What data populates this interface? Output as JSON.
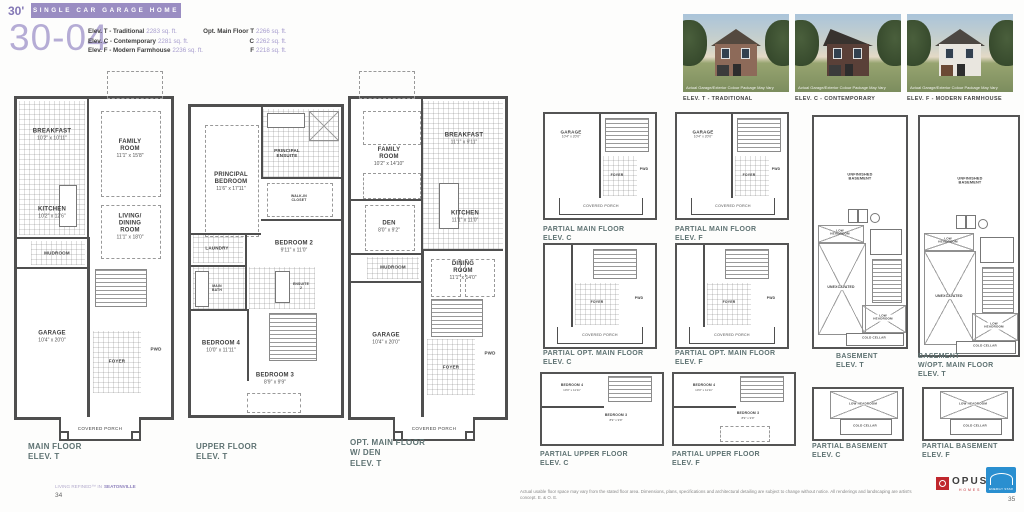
{
  "header": {
    "lot_width": "30'",
    "banner_title": "SINGLE CAR GARAGE HOME",
    "model_number": "30-04"
  },
  "specs": {
    "rows": [
      {
        "label": "Elev. T - Traditional",
        "value": "2283 sq. ft."
      },
      {
        "label": "Elev. C - Contemporary",
        "value": "2281 sq. ft."
      },
      {
        "label": "Elev. F - Modern Farmhouse",
        "value": "2236 sq. ft."
      }
    ],
    "opt_rows": [
      {
        "label": "Opt. Main Floor T",
        "value": "2266 sq. ft."
      },
      {
        "label": "C",
        "value": "2262 sq. ft."
      },
      {
        "label": "F",
        "value": "2218 sq. ft."
      }
    ]
  },
  "elevation_photos": [
    {
      "caption": "ELEV. T - TRADITIONAL",
      "note": "Actual Garage/Exterior Colour Package May Vary"
    },
    {
      "caption": "ELEV. C - CONTEMPORARY",
      "note": "Actual Garage/Exterior Colour Package May Vary"
    },
    {
      "caption": "ELEV. F - MODERN FARMHOUSE",
      "note": "Actual Garage/Exterior Colour Package May Vary"
    }
  ],
  "plans": {
    "main_t": {
      "label": "MAIN FLOOR\nELEV. T",
      "breakfast_name": "BREAKFAST",
      "breakfast_dims": "10'2\" x 10'11\"",
      "family_name": "FAMILY ROOM",
      "family_dims": "11'1\" x 15'8\"",
      "kitchen_name": "KITCHEN",
      "kitchen_dims": "10'2\" x 12'6\"",
      "mudroom_name": "MUDROOM",
      "living_name": "LIVING/\nDINING ROOM",
      "living_dims": "11'1\" x 18'0\"",
      "garage_name": "GARAGE",
      "garage_dims": "10'4\" x 20'0\"",
      "foyer_name": "FOYER",
      "pwd_name": "PWD",
      "porch_name": "COVERED PORCH"
    },
    "upper_t": {
      "label": "UPPER FLOOR\nELEV. T",
      "principal_name": "PRINCIPAL\nBEDROOM",
      "principal_dims": "11'6\" x 17'11\"",
      "ensuite_name": "PRINCIPAL\nENSUITE",
      "wic_name": "WALK-IN\nCLOSET",
      "laundry_name": "LAUNDRY",
      "bedroom2_name": "BEDROOM 2",
      "bedroom2_dims": "9'11\" x 11'0\"",
      "mainbath_name": "MAIN\nBATH",
      "ensuite2_name": "ENSUITE\n2",
      "bedroom4_name": "BEDROOM 4",
      "bedroom4_dims": "10'0\" x 11'11\"",
      "bedroom3_name": "BEDROOM 3",
      "bedroom3_dims": "8'9\" x 9'9\""
    },
    "opt_main_t": {
      "label": "OPT. MAIN FLOOR\nW/ DEN\nELEV. T",
      "family_name": "FAMILY\nROOM",
      "family_dims": "10'2\" x 14'10\"",
      "breakfast_name": "BREAKFAST",
      "breakfast_dims": "11'1\" x 9'11\"",
      "den_name": "DEN",
      "den_dims": "8'0\" x 9'2\"",
      "kitchen_name": "KITCHEN",
      "kitchen_dims": "11'1\" x 11'0\"",
      "mudroom_name": "MUDROOM",
      "dining_name": "DINING ROOM",
      "dining_dims": "11'1\" x 14'0\"",
      "garage_name": "GARAGE",
      "garage_dims": "10'4\" x 20'0\"",
      "foyer_name": "FOYER",
      "pwd_name": "PWD",
      "porch_name": "COVERED PORCH"
    },
    "partial_main_c": {
      "label": "PARTIAL MAIN FLOOR\nELEV. C",
      "garage_name": "GARAGE",
      "garage_dims": "10'4\" x 20'0\"",
      "foyer_name": "FOYER",
      "pwd_name": "PWD",
      "porch_name": "COVERED PORCH"
    },
    "partial_main_f": {
      "label": "PARTIAL MAIN FLOOR\nELEV. F",
      "garage_name": "GARAGE",
      "garage_dims": "10'4\" x 20'0\"",
      "foyer_name": "FOYER",
      "pwd_name": "PWD",
      "porch_name": "COVERED PORCH"
    },
    "partial_opt_c": {
      "label": "PARTIAL OPT. MAIN FLOOR\nELEV. C",
      "foyer_name": "FOYER",
      "pwd_name": "PWD",
      "porch_name": "COVERED PORCH"
    },
    "partial_opt_f": {
      "label": "PARTIAL OPT. MAIN FLOOR\nELEV. F",
      "foyer_name": "FOYER",
      "pwd_name": "PWD",
      "porch_name": "COVERED PORCH"
    },
    "partial_upper_c": {
      "label": "PARTIAL UPPER FLOOR\nELEV. C",
      "bedroom4_name": "BEDROOM 4",
      "bedroom4_dims": "10'0\" x 11'11\"",
      "bedroom3_name": "BEDROOM 3",
      "bedroom3_dims": "8'9\" x 9'9\""
    },
    "partial_upper_f": {
      "label": "PARTIAL UPPER FLOOR\nELEV. F",
      "bedroom4_name": "BEDROOM 4",
      "bedroom4_dims": "10'0\" x 11'11\"",
      "bedroom3_name": "BEDROOM 3",
      "bedroom3_dims": "8'9\" x 9'9\""
    },
    "basement_t": {
      "label": "BASEMENT\nELEV. T",
      "unfinished_name": "UNFINISHED\nBASEMENT",
      "low_headroom_name": "LOW\nHEADROOM",
      "unexcavated_name": "UNEXCAVATED",
      "low_headroom2_name": "LOW HEADROOM",
      "cold_cellar_name": "COLD CELLAR"
    },
    "basement_opt_t": {
      "label": "BASEMENT\nW/OPT. MAIN FLOOR\nELEV. T",
      "unfinished_name": "UNFINISHED\nBASEMENT",
      "low_headroom_name": "LOW\nHEADROOM",
      "unexcavated_name": "UNEXCAVATED",
      "low_headroom2_name": "LOW HEADROOM",
      "cold_cellar_name": "COLD CELLAR"
    },
    "partial_basement_c": {
      "label": "PARTIAL BASEMENT\nELEV.  C",
      "low_headroom_name": "LOW HEADROOM",
      "cold_cellar_name": "COLD CELLAR"
    },
    "partial_basement_f": {
      "label": "PARTIAL BASEMENT\nELEV. F",
      "low_headroom_name": "LOW HEADROOM",
      "cold_cellar_name": "COLD CELLAR"
    }
  },
  "footer": {
    "tagline_prefix": "LIVING REFINED™ IN",
    "tagline_community": "SEATONVILLE",
    "page_left": "34",
    "disclaimer": "Actual usable floor space may vary from the stated floor area. Dimensions, plans, specifications and architectural detailing are subject to change without notice. All renderings and landscaping are artist's concept. E. & O. E.",
    "opus_name": "OPUS",
    "opus_sub": "HOMES",
    "energy_star": "ENERGY STAR",
    "page_right": "35"
  },
  "colors": {
    "accent_purple": "#9a8dc2",
    "light_purple": "#b5acd5",
    "plan_label_teal": "#5e7272",
    "opus_red": "#c0272d",
    "energy_star_blue": "#2a8fd0"
  }
}
